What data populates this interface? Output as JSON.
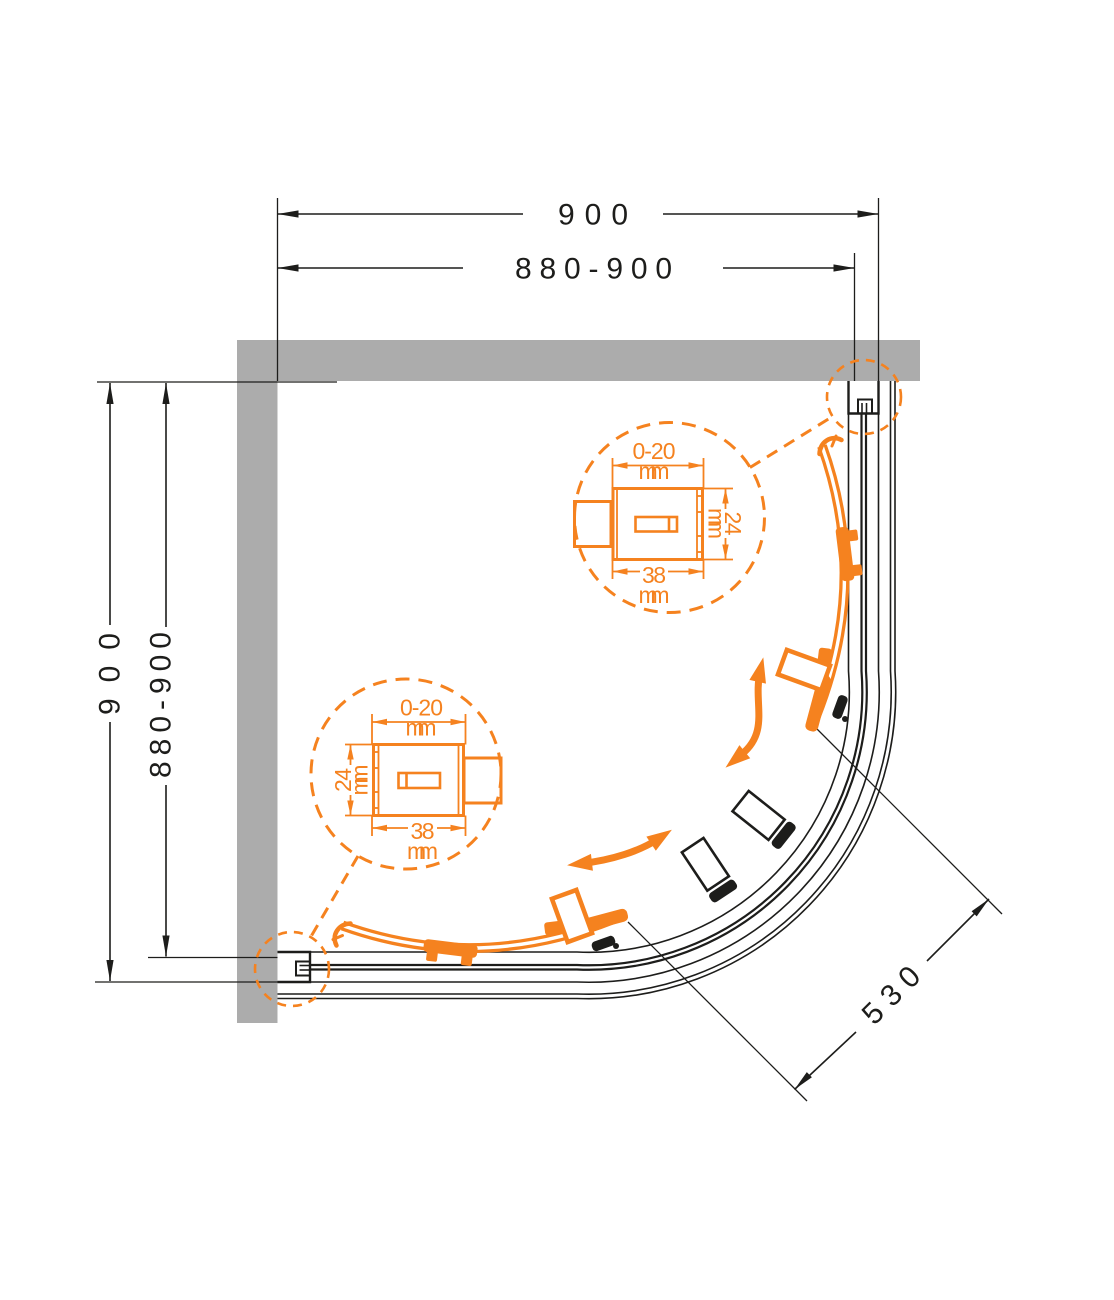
{
  "dimensions": {
    "top_overall": "900",
    "top_adjustable": "880-900",
    "left_overall": "900",
    "left_adjustable": "880-900",
    "entry_diagonal": "530"
  },
  "detail_top": {
    "adjust_range": "0-20",
    "adjust_unit": "mm",
    "depth": "24",
    "depth_unit": "mm",
    "width": "38",
    "width_unit": "mm"
  },
  "detail_bottom": {
    "adjust_range": "0-20",
    "adjust_unit": "mm",
    "depth": "24",
    "depth_unit": "mm",
    "width": "38",
    "width_unit": "mm"
  },
  "colors": {
    "accent_orange": "#F5821F",
    "wall_gray": "#ACACAC",
    "line_black": "#1D1D1B"
  }
}
